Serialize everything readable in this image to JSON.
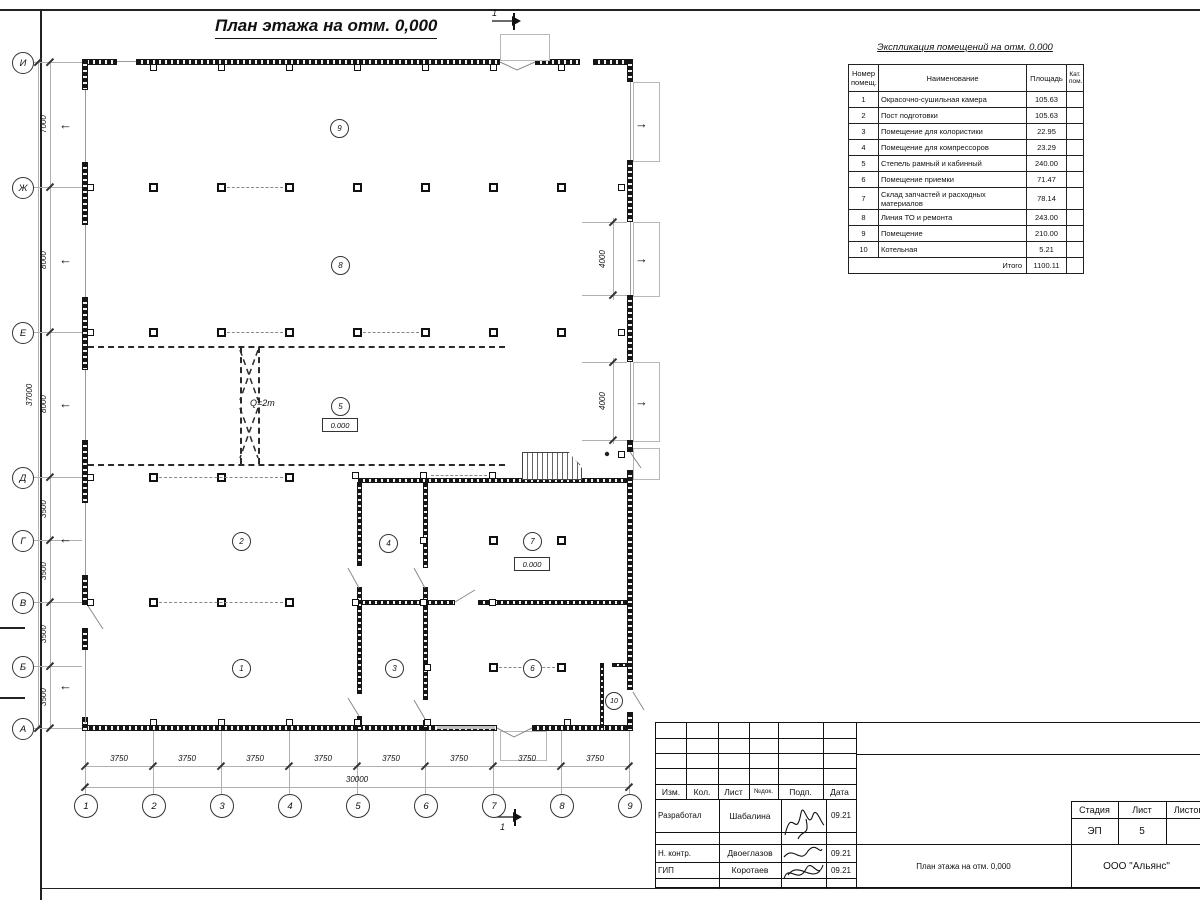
{
  "sheet_title": "План этажа на отм. 0,000",
  "explication": {
    "title": "Экспликация помещений на отм. 0.000",
    "headers": {
      "num": "Номер помещ.",
      "name": "Наименование",
      "area": "Площадь",
      "cat": "Кат. пом."
    },
    "rows": [
      {
        "num": "1",
        "name": "Окрасочно-сушильная камера",
        "area": "105.63"
      },
      {
        "num": "2",
        "name": "Пост подготовки",
        "area": "105.63"
      },
      {
        "num": "3",
        "name": "Помещение для колористики",
        "area": "22.95"
      },
      {
        "num": "4",
        "name": "Помещение для компрессоров",
        "area": "23.29"
      },
      {
        "num": "5",
        "name": "Степель рамный и кабинный",
        "area": "240.00"
      },
      {
        "num": "6",
        "name": "Помещение приемки",
        "area": "71.47"
      },
      {
        "num": "7",
        "name": "Склад запчастей и расходных материалов",
        "area": "78.14"
      },
      {
        "num": "8",
        "name": "Линия ТО и ремонта",
        "area": "243.00"
      },
      {
        "num": "9",
        "name": "Помещение",
        "area": "210.00"
      },
      {
        "num": "10",
        "name": "Котельная",
        "area": "5.21"
      }
    ],
    "total_label": "Итого",
    "total_value": "1100.11"
  },
  "axes": {
    "rows": [
      "И",
      "Ж",
      "Е",
      "Д",
      "Г",
      "В",
      "Б",
      "А"
    ],
    "cols": [
      "1",
      "2",
      "3",
      "4",
      "5",
      "6",
      "7",
      "8",
      "9"
    ]
  },
  "dims": {
    "left": [
      "7000",
      "8000",
      "8000",
      "3500",
      "3500",
      "3500",
      "3500"
    ],
    "left_total": "37000",
    "bottom": [
      "3750",
      "3750",
      "3750",
      "3750",
      "3750",
      "3750",
      "3750",
      "3750"
    ],
    "bottom_total": "30000",
    "right": [
      "4000",
      "4000"
    ]
  },
  "plan": {
    "room_numbers": [
      "1",
      "2",
      "3",
      "4",
      "5",
      "6",
      "7",
      "8",
      "9",
      "10"
    ],
    "elevation_mark": "0.000",
    "crane_label": "Q=2т",
    "section_label": "1"
  },
  "titleblock": {
    "cols": [
      "Изм.",
      "Кол.",
      "Лист",
      "№док.",
      "Подп.",
      "Дата"
    ],
    "rows": [
      {
        "role": "Разработал",
        "name": "Шабалина",
        "date": "09.21"
      },
      {
        "role": "Н. контр.",
        "name": "Двоеглазов",
        "date": "09.21"
      },
      {
        "role": "ГИП",
        "name": "Коротаев",
        "date": "09.21"
      }
    ],
    "doc_title": "План этажа на отм. 0,000",
    "stage_label": "Стадия",
    "sheet_label": "Лист",
    "sheets_label": "Листов",
    "stage": "ЭП",
    "sheet": "5",
    "company": "ООО \"Альянс\""
  }
}
